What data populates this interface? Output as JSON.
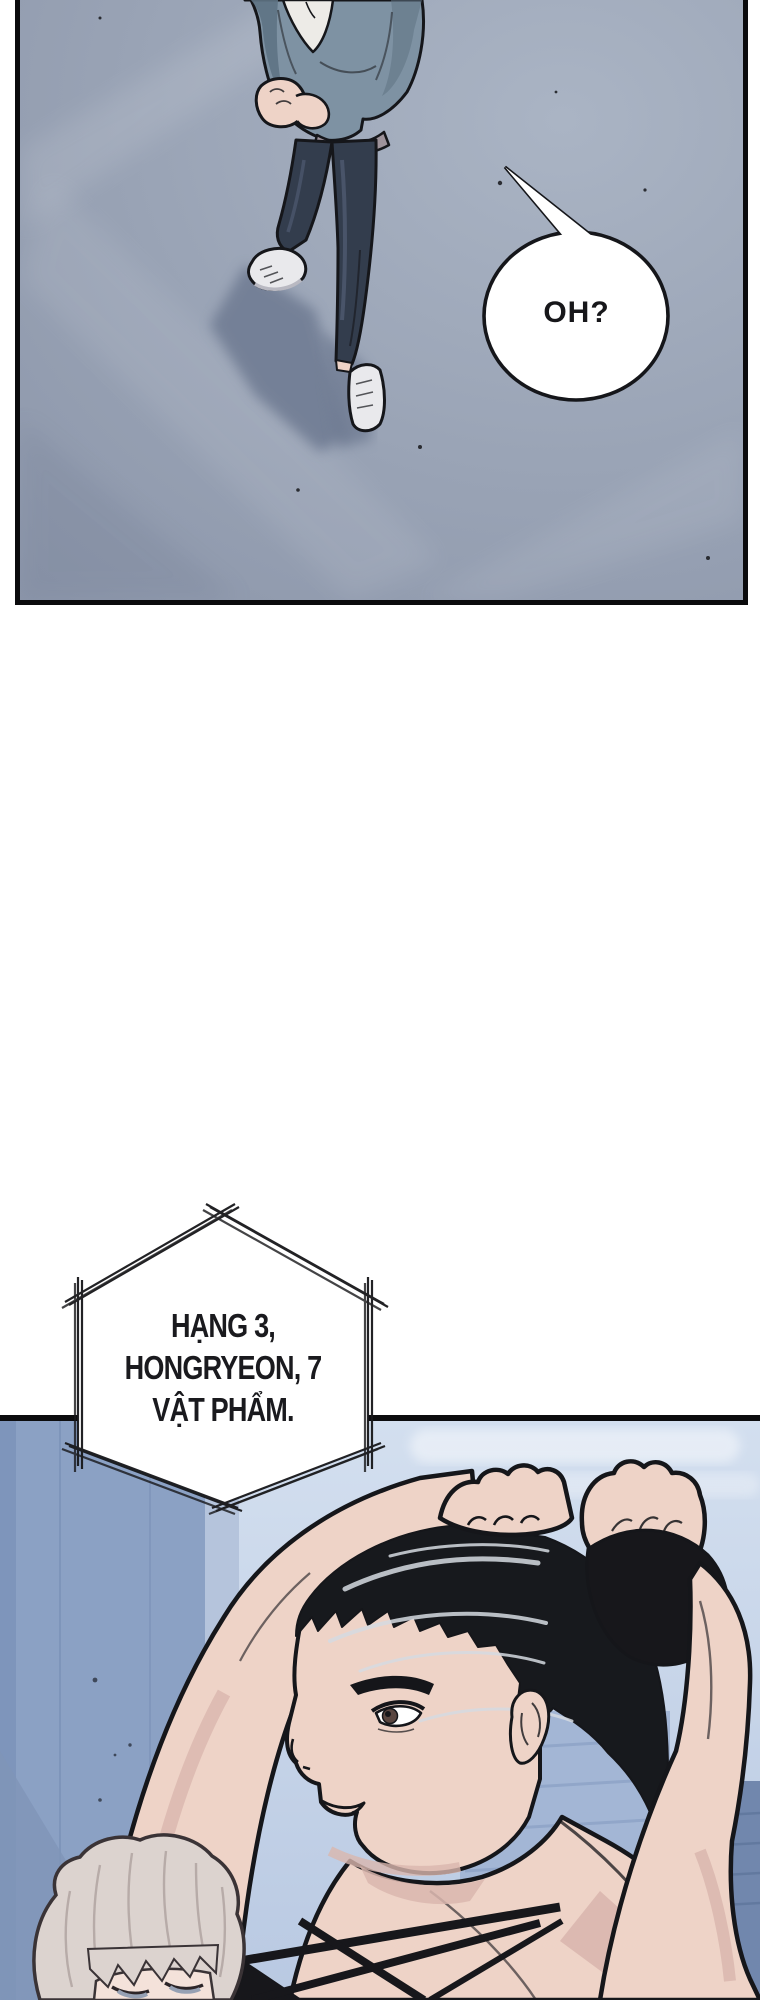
{
  "page": {
    "kind": "webtoon comic page",
    "background": "#ffffff"
  },
  "panel_1": {
    "scene": "Top-down bird's-eye view of a man standing on a blue-grey concrete rooftop, arms crossed at his chest, casting a long shadow to the lower left",
    "speech_bubble": {
      "text": "OH?"
    }
  },
  "caption_hexagon": {
    "shape": "hand-sketched triple-line hexagon",
    "lines": [
      "HẠNG 3,",
      "HONGRYEON, 7",
      "VẬT PHẨM."
    ]
  },
  "panel_2": {
    "scene": "Low-angle close-up of a muscular black-haired character tying hair into a ponytail with both fists, black wristband, hazy blue high-rise skyline behind; a pale white-haired onlooker at the lower left"
  },
  "palette": {
    "ink": "#15161a",
    "floor": "#99a3b5",
    "floor_light": "#aab4c4",
    "floor_shadow": "#6e7a92",
    "jacket": "#7e92a3",
    "jacket_shadow": "#5e7384",
    "shirt": "#edebe7",
    "shirt_hem": "#9e939b",
    "pants": "#333d4d",
    "pants_highlight": "#4b566d",
    "shoe": "#e9e9ec",
    "skin": "#eed3c7",
    "skin_shadow": "#d9b6ae",
    "bubble_fill": "#ffffff",
    "sky_top": "#d3dfef",
    "sky_bottom": "#b9c9e2",
    "building_left": "#8ba1c4",
    "building_mid": "#a3b6d5",
    "building_dark": "#7187ad",
    "hair_black": "#17191d",
    "hair_highlight": "#d6dbe2",
    "white_hair": "#dcd3cf",
    "white_hair_shadow": "#b3a7a4",
    "strap_black": "#17171b"
  }
}
